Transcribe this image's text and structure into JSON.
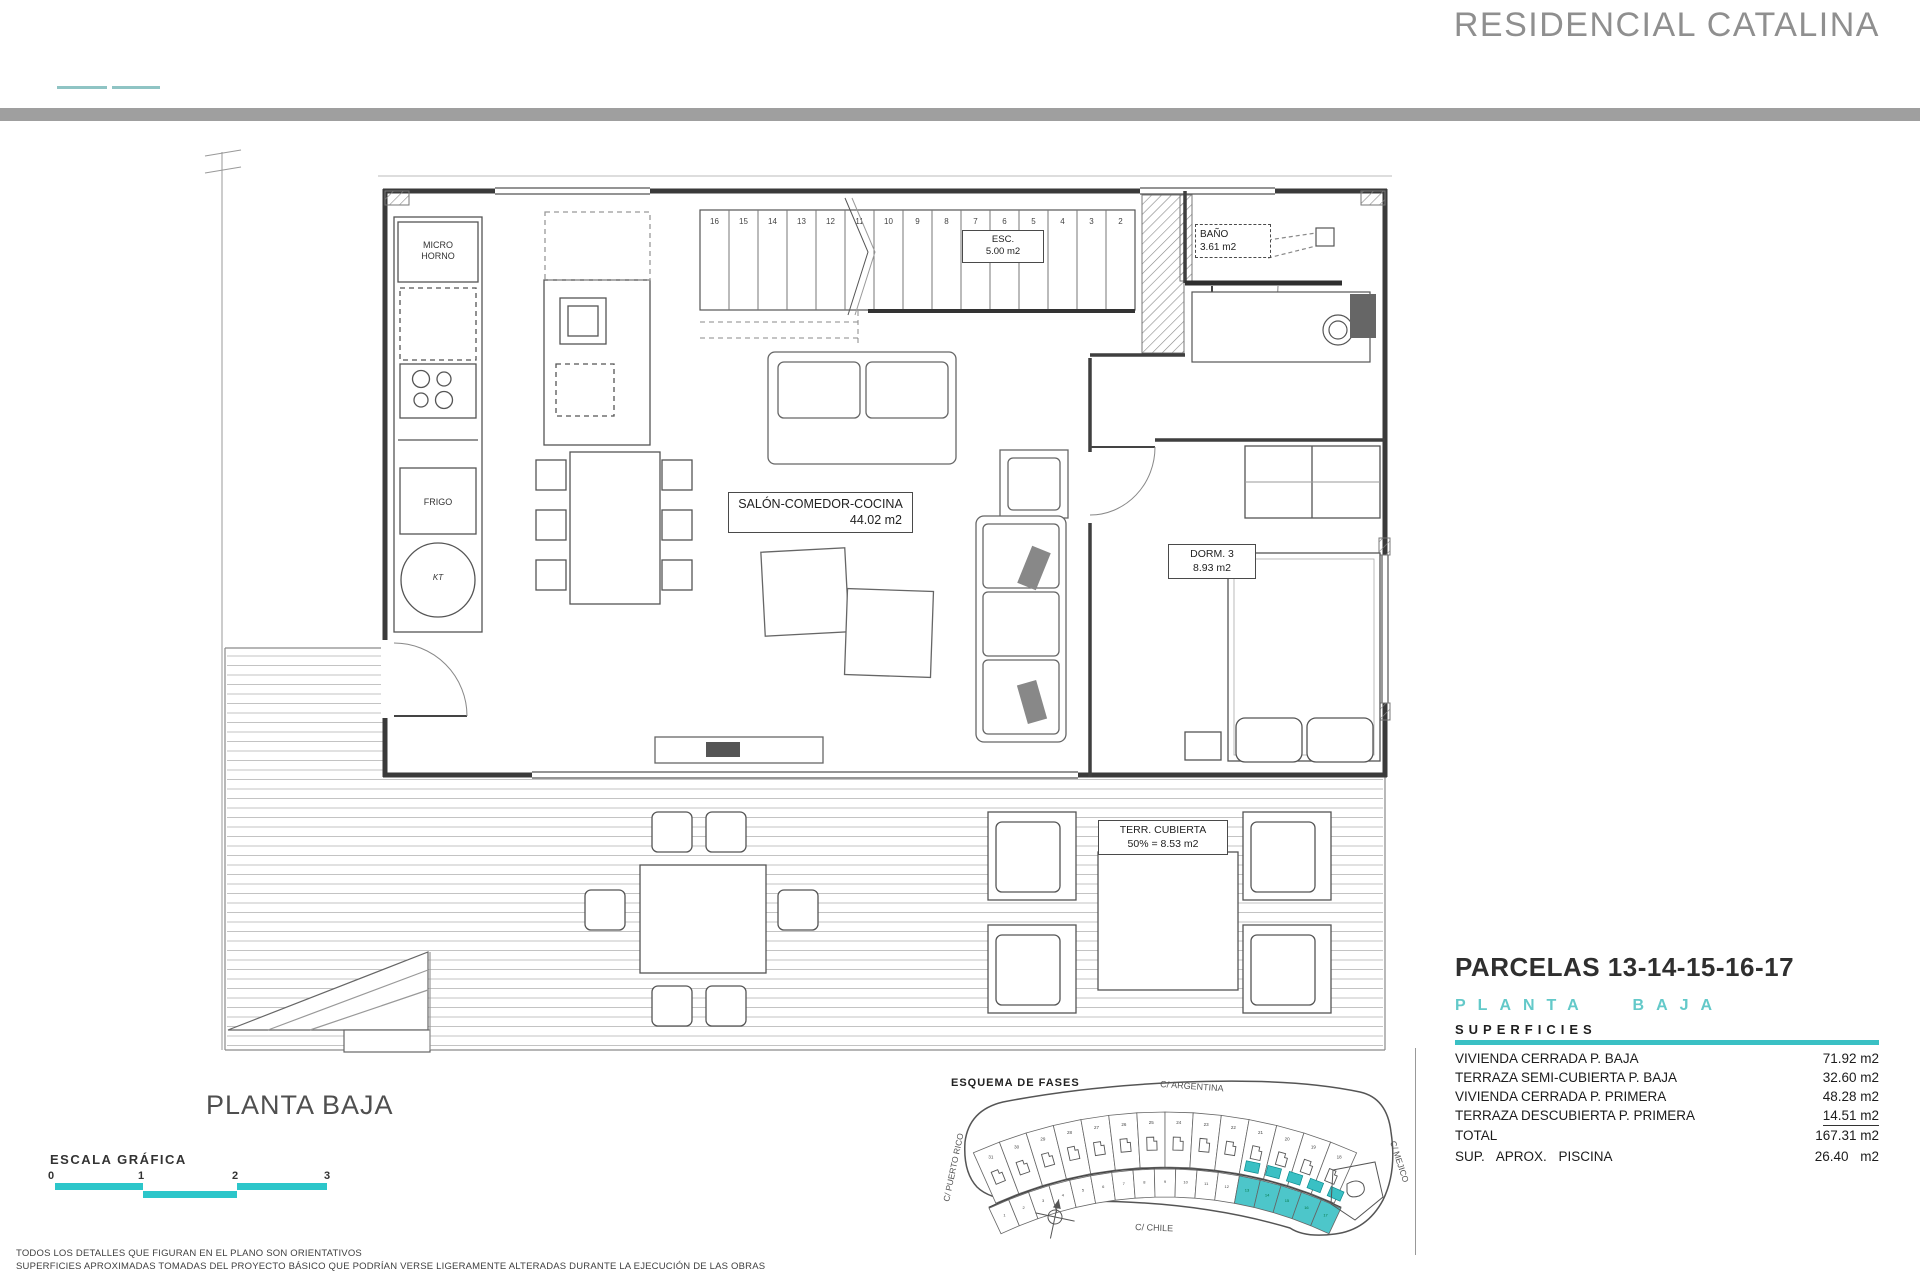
{
  "header": {
    "title": "RESIDENCIAL CATALINA"
  },
  "plan": {
    "rooms": {
      "salon": {
        "name": "SALÓN-COMEDOR-COCINA",
        "area": "44.02 m2"
      },
      "bano": {
        "name": "BAÑO",
        "area": "3.61 m2"
      },
      "dorm3": {
        "name": "DORM. 3",
        "area": "8.93 m2"
      },
      "terraza": {
        "name": "TERR. CUBIERTA",
        "area": "50% = 8.53 m2"
      },
      "esc": {
        "name": "ESC.",
        "area": "5.00 m2"
      }
    },
    "kitchen": {
      "micro": "MICRO",
      "horno": "HORNO",
      "frigo": "FRIGO",
      "kt": "KT"
    },
    "stair_numbers": [
      "16",
      "15",
      "14",
      "13",
      "12",
      "11",
      "10",
      "9",
      "8",
      "7",
      "6",
      "5",
      "4",
      "3",
      "2"
    ]
  },
  "info": {
    "parcels_title": "PARCELAS 13-14-15-16-17",
    "floor_heading": "PLANTA BAJA",
    "superficies_label": "SUPERFICIES",
    "rows": [
      {
        "label": "VIVIENDA CERRADA P. BAJA",
        "value": "71.92 m2"
      },
      {
        "label": "TERRAZA SEMI-CUBIERTA P. BAJA",
        "value": "32.60 m2"
      },
      {
        "label": "VIVIENDA CERRADA P. PRIMERA",
        "value": "48.28 m2"
      },
      {
        "label": "TERRAZA DESCUBIERTA P. PRIMERA",
        "value": "14.51 m2"
      },
      {
        "label": "TOTAL",
        "value": "167.31 m2"
      }
    ],
    "piscina": {
      "label": "SUP.  APROX.  PISCINA",
      "value": "26.40 m2"
    }
  },
  "footer": {
    "plan_title": "PLANTA BAJA",
    "scale_label": "ESCALA GRÁFICA",
    "scale_ticks": [
      "0",
      "1",
      "2",
      "3"
    ],
    "disclaimer1": "TODOS LOS DETALLES QUE FIGURAN EN EL PLANO SON ORIENTATIVOS",
    "disclaimer2": "SUPERFICIES APROXIMADAS TOMADAS DEL PROYECTO BÁSICO QUE PODRÍAN VERSE LIGERAMENTE ALTERADAS DURANTE LA EJECUCIÓN DE LAS OBRAS"
  },
  "esquema": {
    "title": "ESQUEMA DE FASES",
    "streets": {
      "top": "C/ ARGENTINA",
      "left": "C/ PUERTO RICO",
      "bottom": "C/ CHILE",
      "right": "C/ MEJICO"
    },
    "top_row_numbers": [
      "31",
      "30",
      "29",
      "28",
      "27",
      "26",
      "25",
      "24",
      "23",
      "22",
      "21",
      "20",
      "19",
      "18"
    ],
    "bottom_row_numbers": [
      "1",
      "2",
      "3",
      "4",
      "5",
      "6",
      "7",
      "8",
      "9",
      "10",
      "11",
      "12",
      "13",
      "14",
      "15",
      "16",
      "17"
    ],
    "highlighted_numbers": [
      "13",
      "14",
      "15",
      "16",
      "17"
    ],
    "highlight_color": "#3ac0c4"
  },
  "colors": {
    "accent_teal": "#3ac0c4",
    "scale_teal": "#2cc6ca",
    "heading_teal": "#63c9c9",
    "header_bar_gray": "#9f9f9f",
    "title_gray": "#8f8f8f",
    "line_dark": "#3a3a3a"
  }
}
